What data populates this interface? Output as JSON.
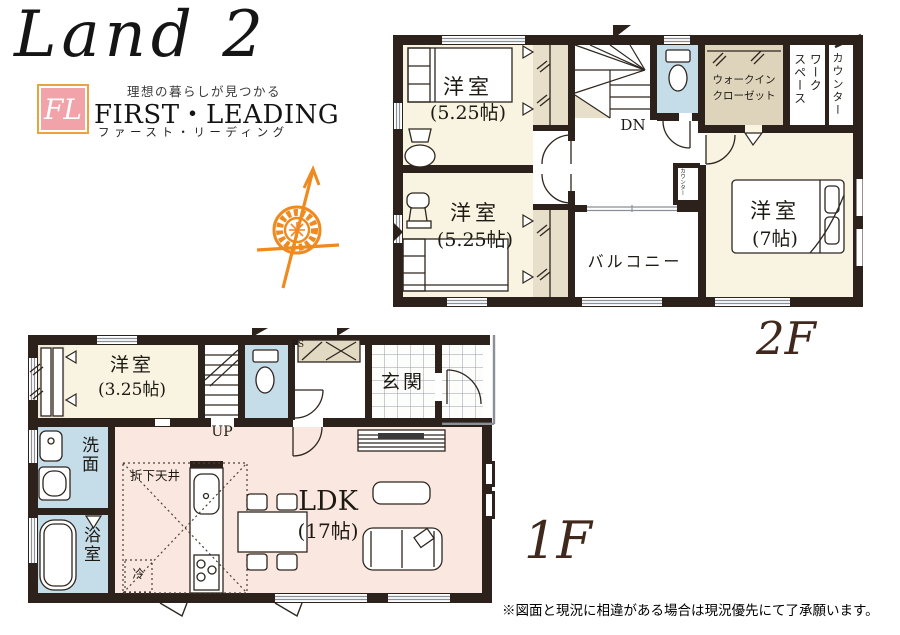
{
  "logo": {
    "title": "Land 2",
    "fl": "FL",
    "tagline": "理想の暮らしが見つかる",
    "brand": "FIRST・LEADING",
    "brand_kana": "ファースト・リーディング"
  },
  "floor_labels": {
    "second": "2F",
    "first": "1F"
  },
  "plan_2f": {
    "bedroom_a": {
      "name": "洋室",
      "size": "(5.25帖)"
    },
    "bedroom_b": {
      "name": "洋室",
      "size": "(5.25帖)"
    },
    "bedroom_c": {
      "name": "洋室",
      "size": "(7帖)"
    },
    "wic_line1": "ウォークイン",
    "wic_line2": "クローゼット",
    "workspace_line1": "ワーク",
    "workspace_line2": "スペース",
    "counter": "カウンター",
    "counter_niche": "カウンター",
    "stairs_down": "DN",
    "balcony": "バルコニー"
  },
  "plan_1f": {
    "bedroom": {
      "name": "洋室",
      "size": "(3.25帖)"
    },
    "stairs_up": "UP",
    "pipe_space": "PS",
    "entrance": "玄関",
    "washroom": "洗面",
    "bathroom": "浴室",
    "ldk": {
      "name": "LDK",
      "size": "(17帖)"
    },
    "dropped_ceiling": "折下天井",
    "fridge": "冷"
  },
  "disclaimer": "※図面と現況に相違がある場合は現況優先にて了承願います。",
  "colors": {
    "wall": "#2D211B",
    "room_cream": "#F8F4E1",
    "wet_blue": "#C4DDE9",
    "ldk_pink": "#FAE8E0",
    "closet_beige": "#E7DFC9",
    "wic_tan": "#DED4BC",
    "accent_orange": "#EE8A1F",
    "logo_pink": "#F2A3A9",
    "floor_label_brown": "#40291C"
  }
}
